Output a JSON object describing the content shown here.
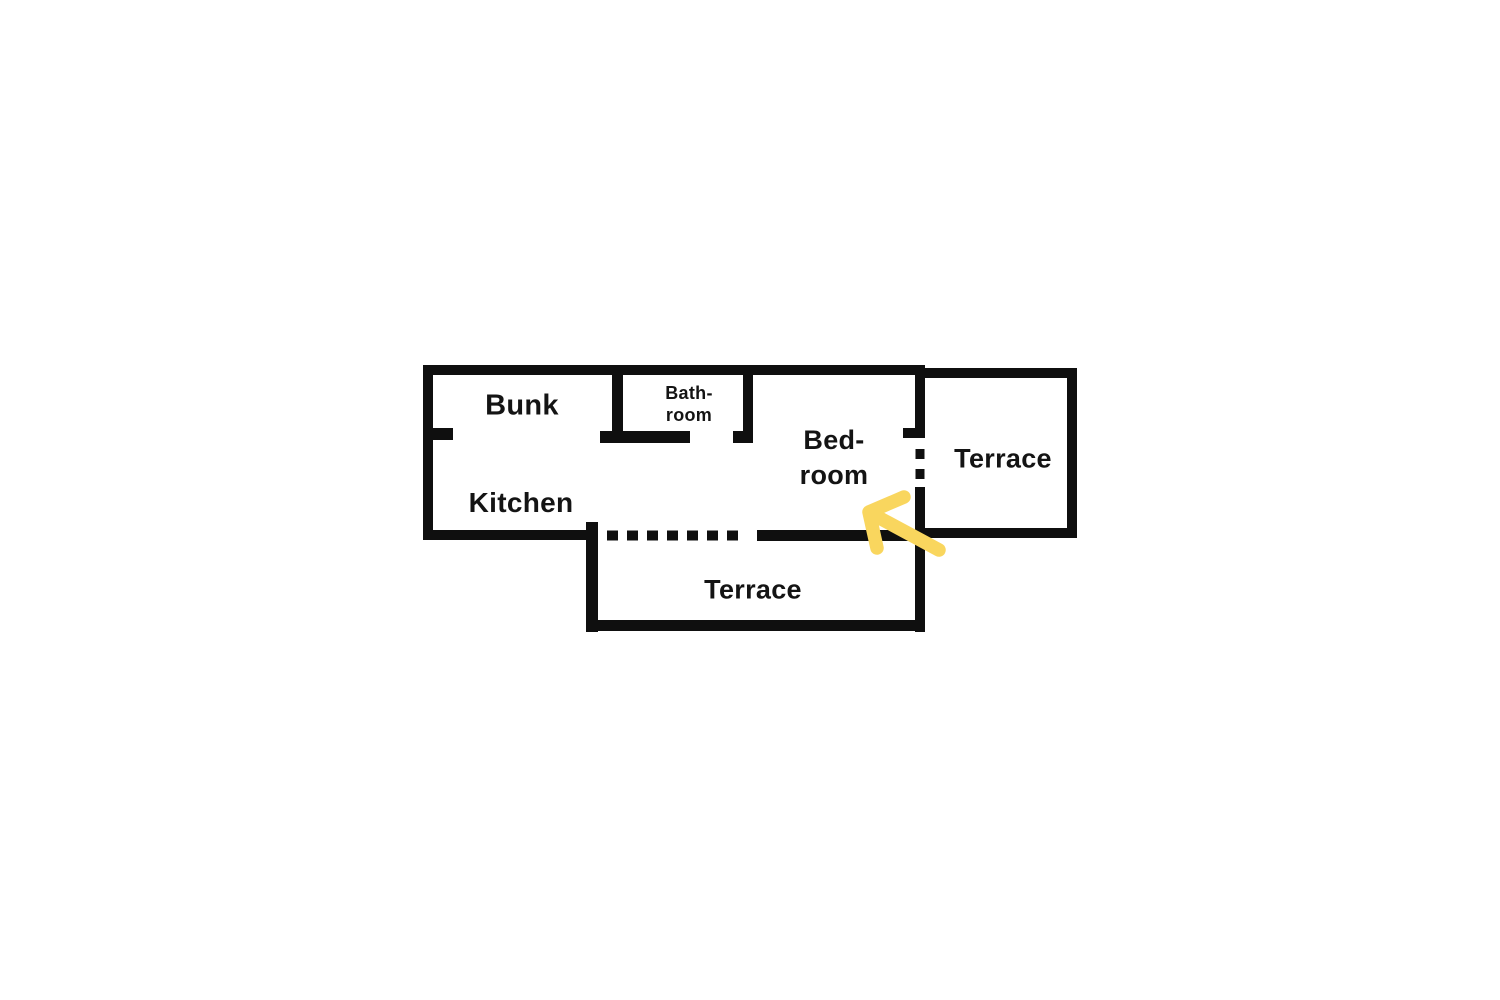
{
  "colors": {
    "wall": "#0f0f0f",
    "text": "#141414",
    "arrow": "#F9D65E",
    "background": "#ffffff"
  },
  "icons": {
    "highlight_arrow": "hand-drawn-arrow-pointing-up-left"
  },
  "plan": {
    "rooms": {
      "bunk": {
        "label": "Bunk"
      },
      "bathroom": {
        "line1": "Bath-",
        "line2": "room"
      },
      "bedroom": {
        "line1": "Bed-",
        "line2": "room"
      },
      "kitchen": {
        "label": "Kitchen"
      },
      "terrace_right": {
        "label": "Terrace"
      },
      "terrace_bottom": {
        "label": "Terrace"
      }
    },
    "doors": {
      "bedroom_to_terrace_right": "dashed-opening",
      "living_to_terrace_bottom": "dashed-opening"
    }
  }
}
